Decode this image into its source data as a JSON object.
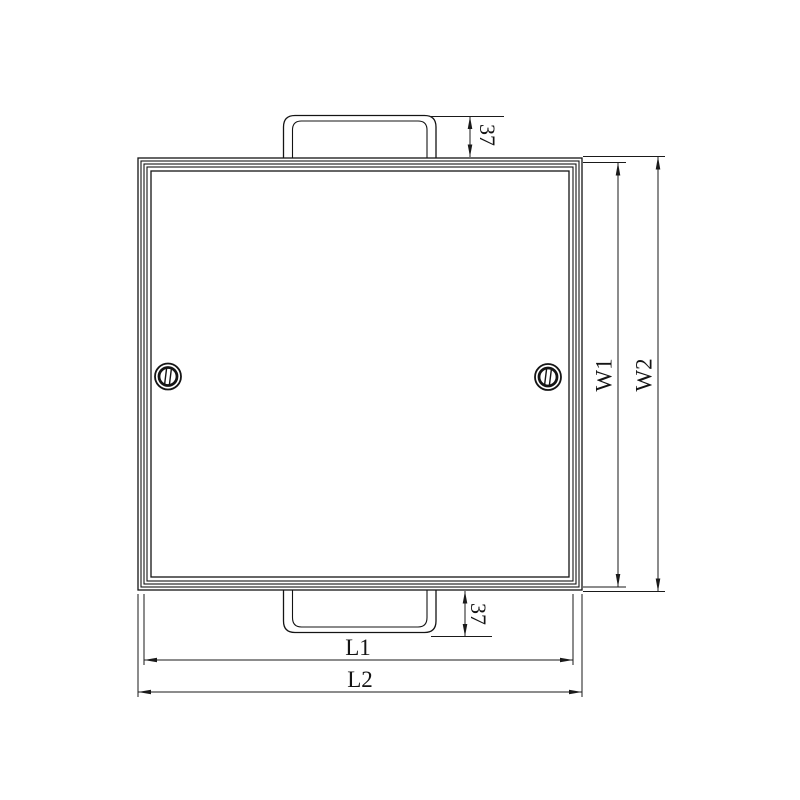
{
  "drawing": {
    "background": "#ffffff",
    "line_color": "#141414",
    "labels": {
      "w1": "W1",
      "w2": "W2",
      "l1": "L1",
      "l2": "L2",
      "tab_top_height": "37",
      "tab_bottom_height": "37"
    }
  }
}
